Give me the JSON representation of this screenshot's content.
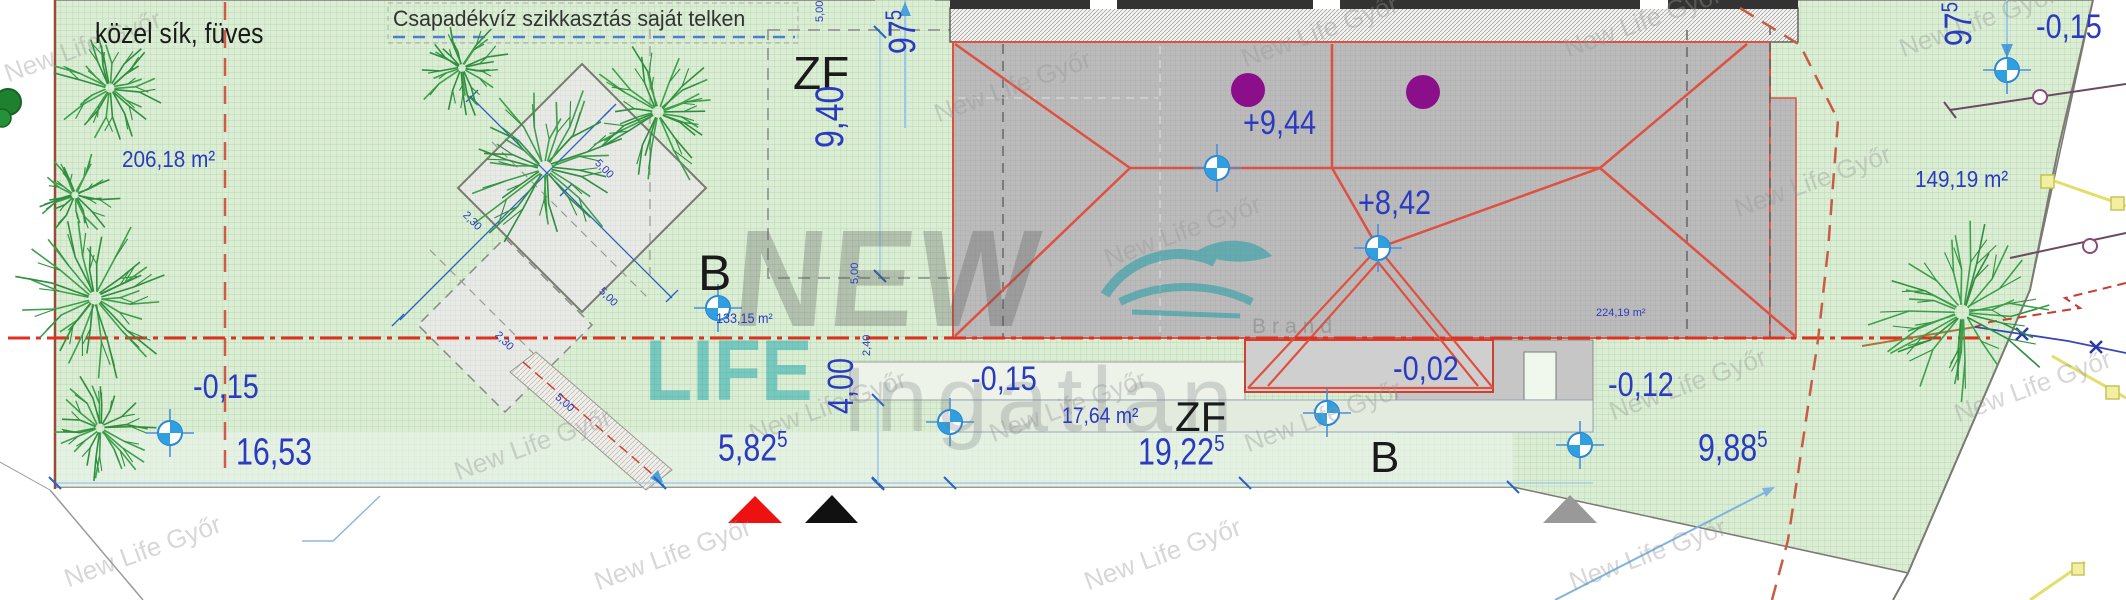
{
  "notes": {
    "terrain": "közel sík, füves",
    "drainage": "Csapadékvíz szikkasztás saját telken"
  },
  "areas": {
    "parcel_left": "206,18 m²",
    "footprint": "133,15 m²",
    "parcel_right": "149,19 m²",
    "terrace": "17,64 m²",
    "roof": "224,19 m²"
  },
  "zone_labels": {
    "zf_top": "ZF",
    "zf_bottom": "ZF",
    "b_left": "B",
    "b_bottom": "B"
  },
  "elevations": {
    "roof_high": "+9,44",
    "roof_mid": "+8,42",
    "terrace": "-0,15",
    "porch": "-0,02",
    "right_ground": "-0,12",
    "left_ground": "-0,15",
    "corner_right": "-0,15"
  },
  "dimensions": {
    "w_left": {
      "v": "16,53",
      "sup": ""
    },
    "w_mid": {
      "v": "5,82",
      "sup": "5"
    },
    "w_house": {
      "v": "19,22",
      "sup": "5"
    },
    "w_right": {
      "v": "9,88",
      "sup": "5"
    },
    "h_zf": {
      "v": "9,40",
      "sup": ""
    },
    "h_small": {
      "v": "4,00",
      "sup": ""
    },
    "off_left": {
      "v": "97",
      "sup": "5"
    },
    "off_right": {
      "v": "97",
      "sup": "5"
    },
    "small": [
      "5,00",
      "2,30",
      "5,00",
      "2,30",
      "5,00",
      "2,40"
    ]
  },
  "watermark": {
    "line1": "NEW",
    "line2": "LIFE",
    "line3": "Ingatlan",
    "brand": "Brand",
    "tiled": "New Life Győr"
  },
  "colors": {
    "dimension_blue": "#2b3bbf",
    "roof_red": "#e05040",
    "boundary_red_dash": "#d04030",
    "grass_green": "#dcedd6",
    "chimney_purple": "#8b0f8b",
    "marker_blue": "#2f9fe0"
  },
  "map_features": {
    "trees": [
      {
        "x": 110,
        "y": 88,
        "r": 58
      },
      {
        "x": 462,
        "y": 68,
        "r": 48
      },
      {
        "x": 545,
        "y": 168,
        "r": 88
      },
      {
        "x": 658,
        "y": 112,
        "r": 72
      },
      {
        "x": 75,
        "y": 195,
        "r": 45
      },
      {
        "x": 95,
        "y": 298,
        "r": 82
      },
      {
        "x": 100,
        "y": 428,
        "r": 56
      },
      {
        "x": 1962,
        "y": 312,
        "r": 92
      }
    ]
  }
}
